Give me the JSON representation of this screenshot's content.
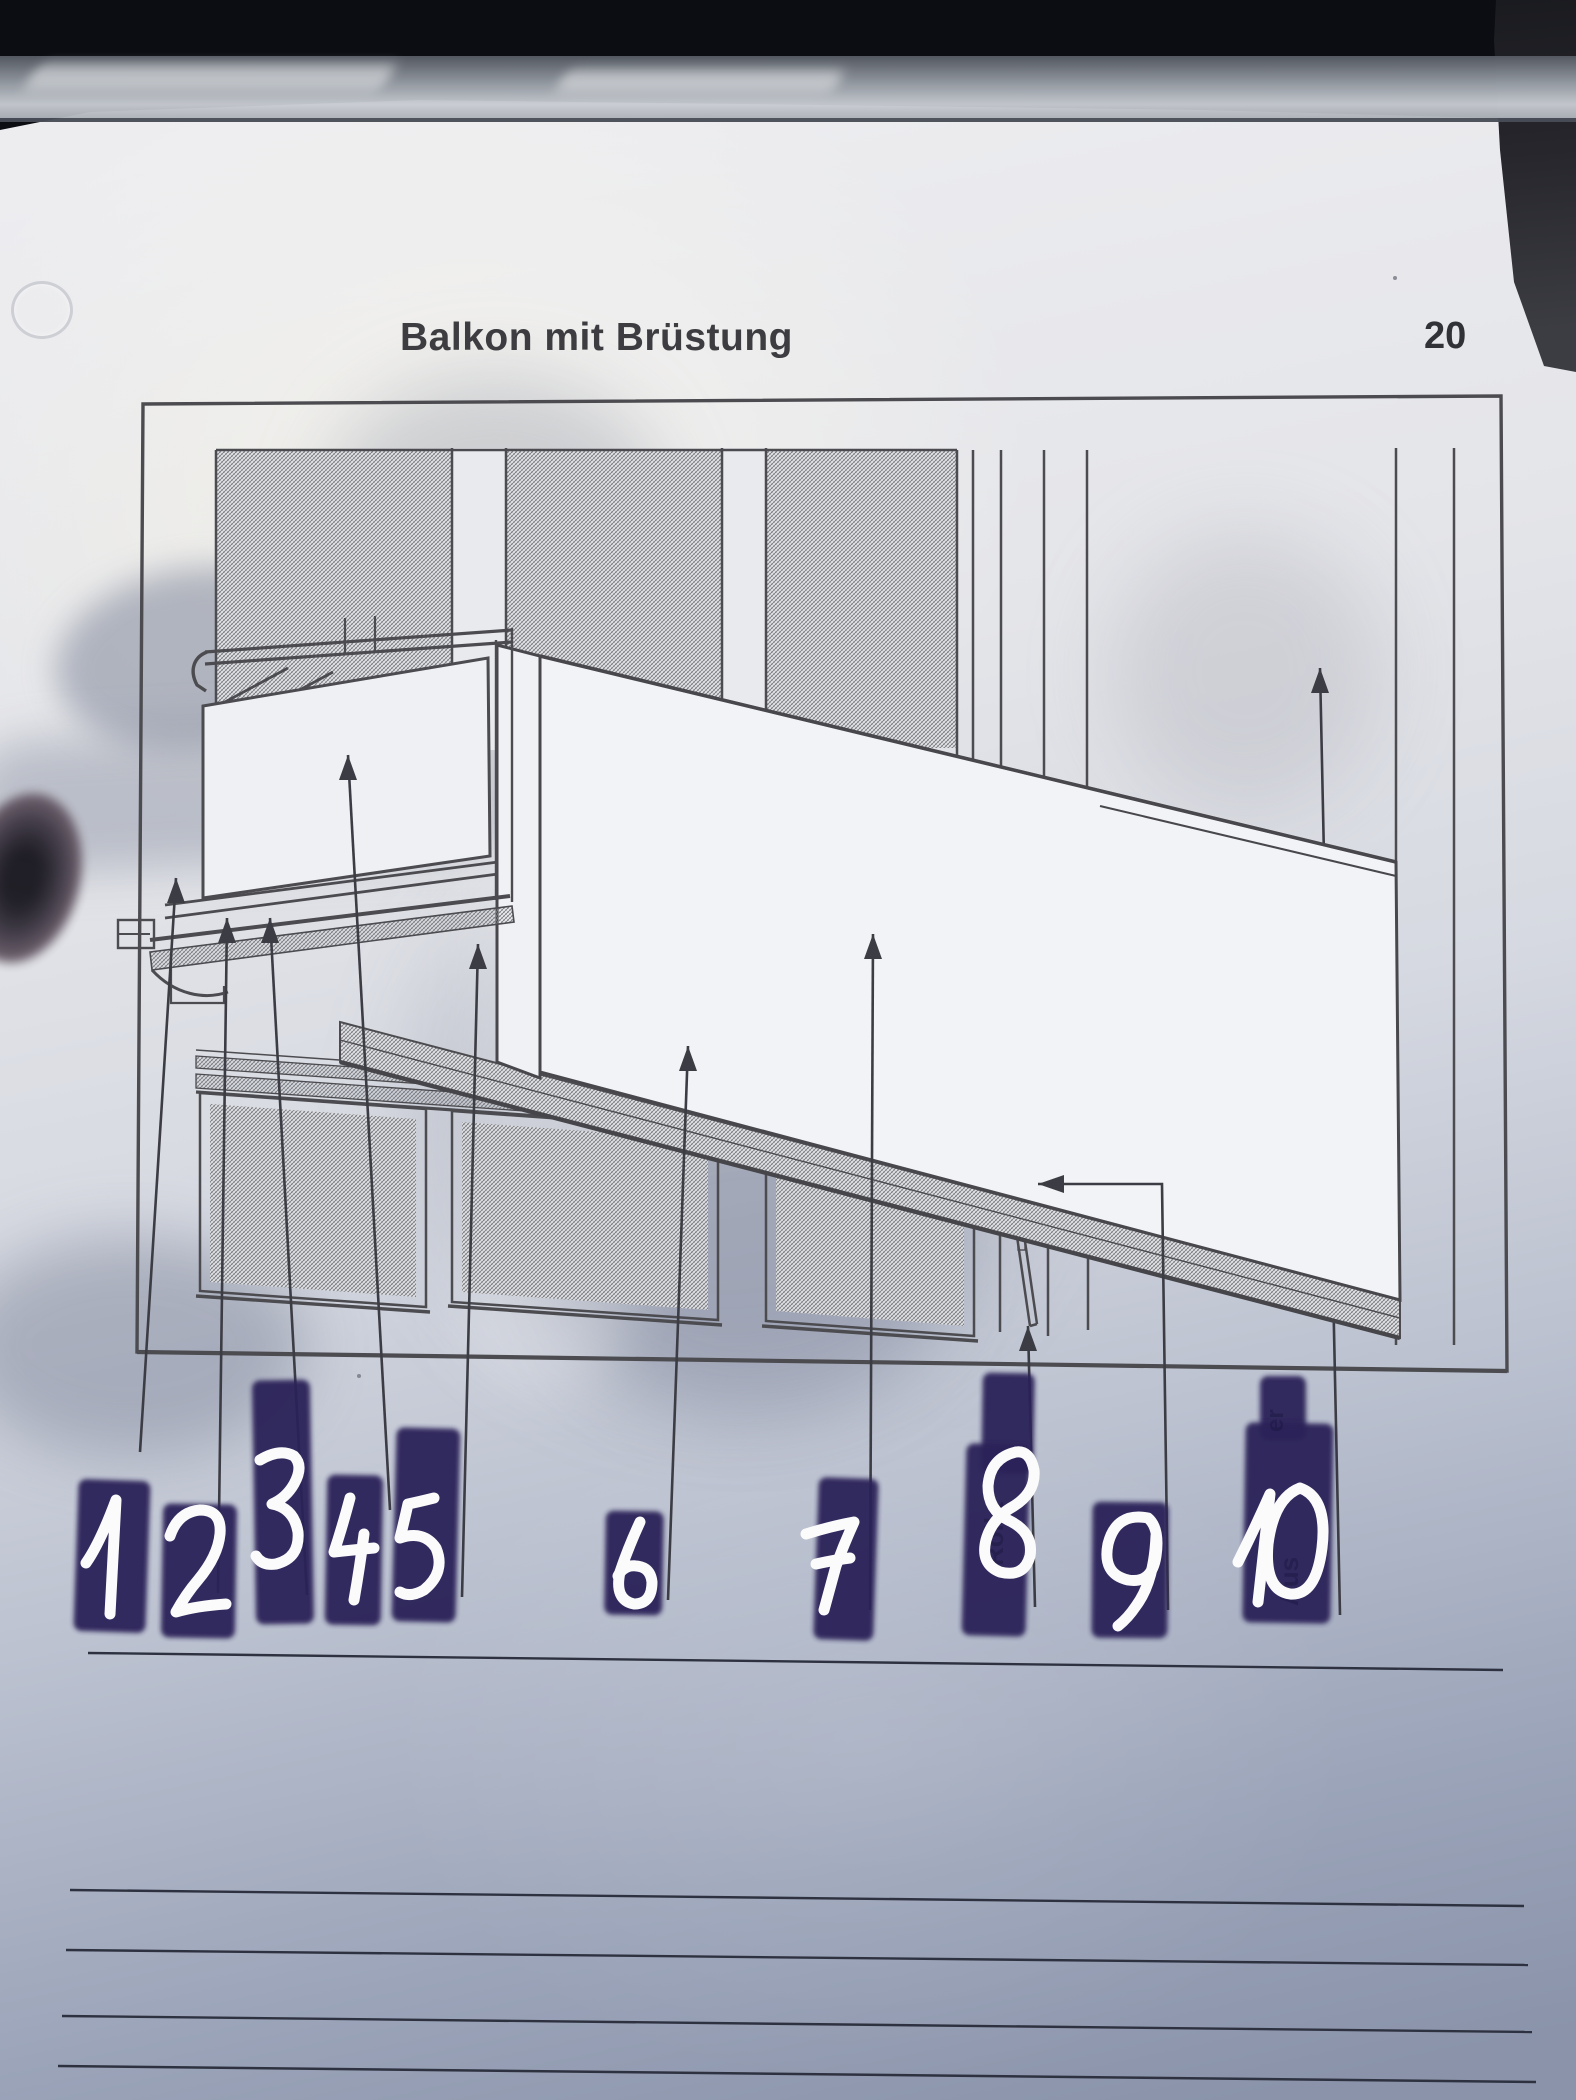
{
  "header": {
    "title": "Balkon mit Brüstung",
    "page_number": "20"
  },
  "worksheet": {
    "labels": [
      "1",
      "2",
      "3",
      "4",
      "5",
      "6",
      "7",
      "8",
      "9",
      "10"
    ],
    "ghost_fragments": [
      {
        "text": "Rolla",
        "near_label": "8"
      },
      {
        "text": "Aus",
        "near_label": "10"
      },
      {
        "text": "er",
        "near_label": "10"
      }
    ],
    "writing_lines_count": 5
  },
  "colors": {
    "highlighter": "#2b2458",
    "marker_ink": "#fbfbfc",
    "print_ink": "#45454a",
    "paper": "#e7e8ec",
    "backdrop": "#0b0d12",
    "page_bottom_tint": "#97a0b5"
  }
}
